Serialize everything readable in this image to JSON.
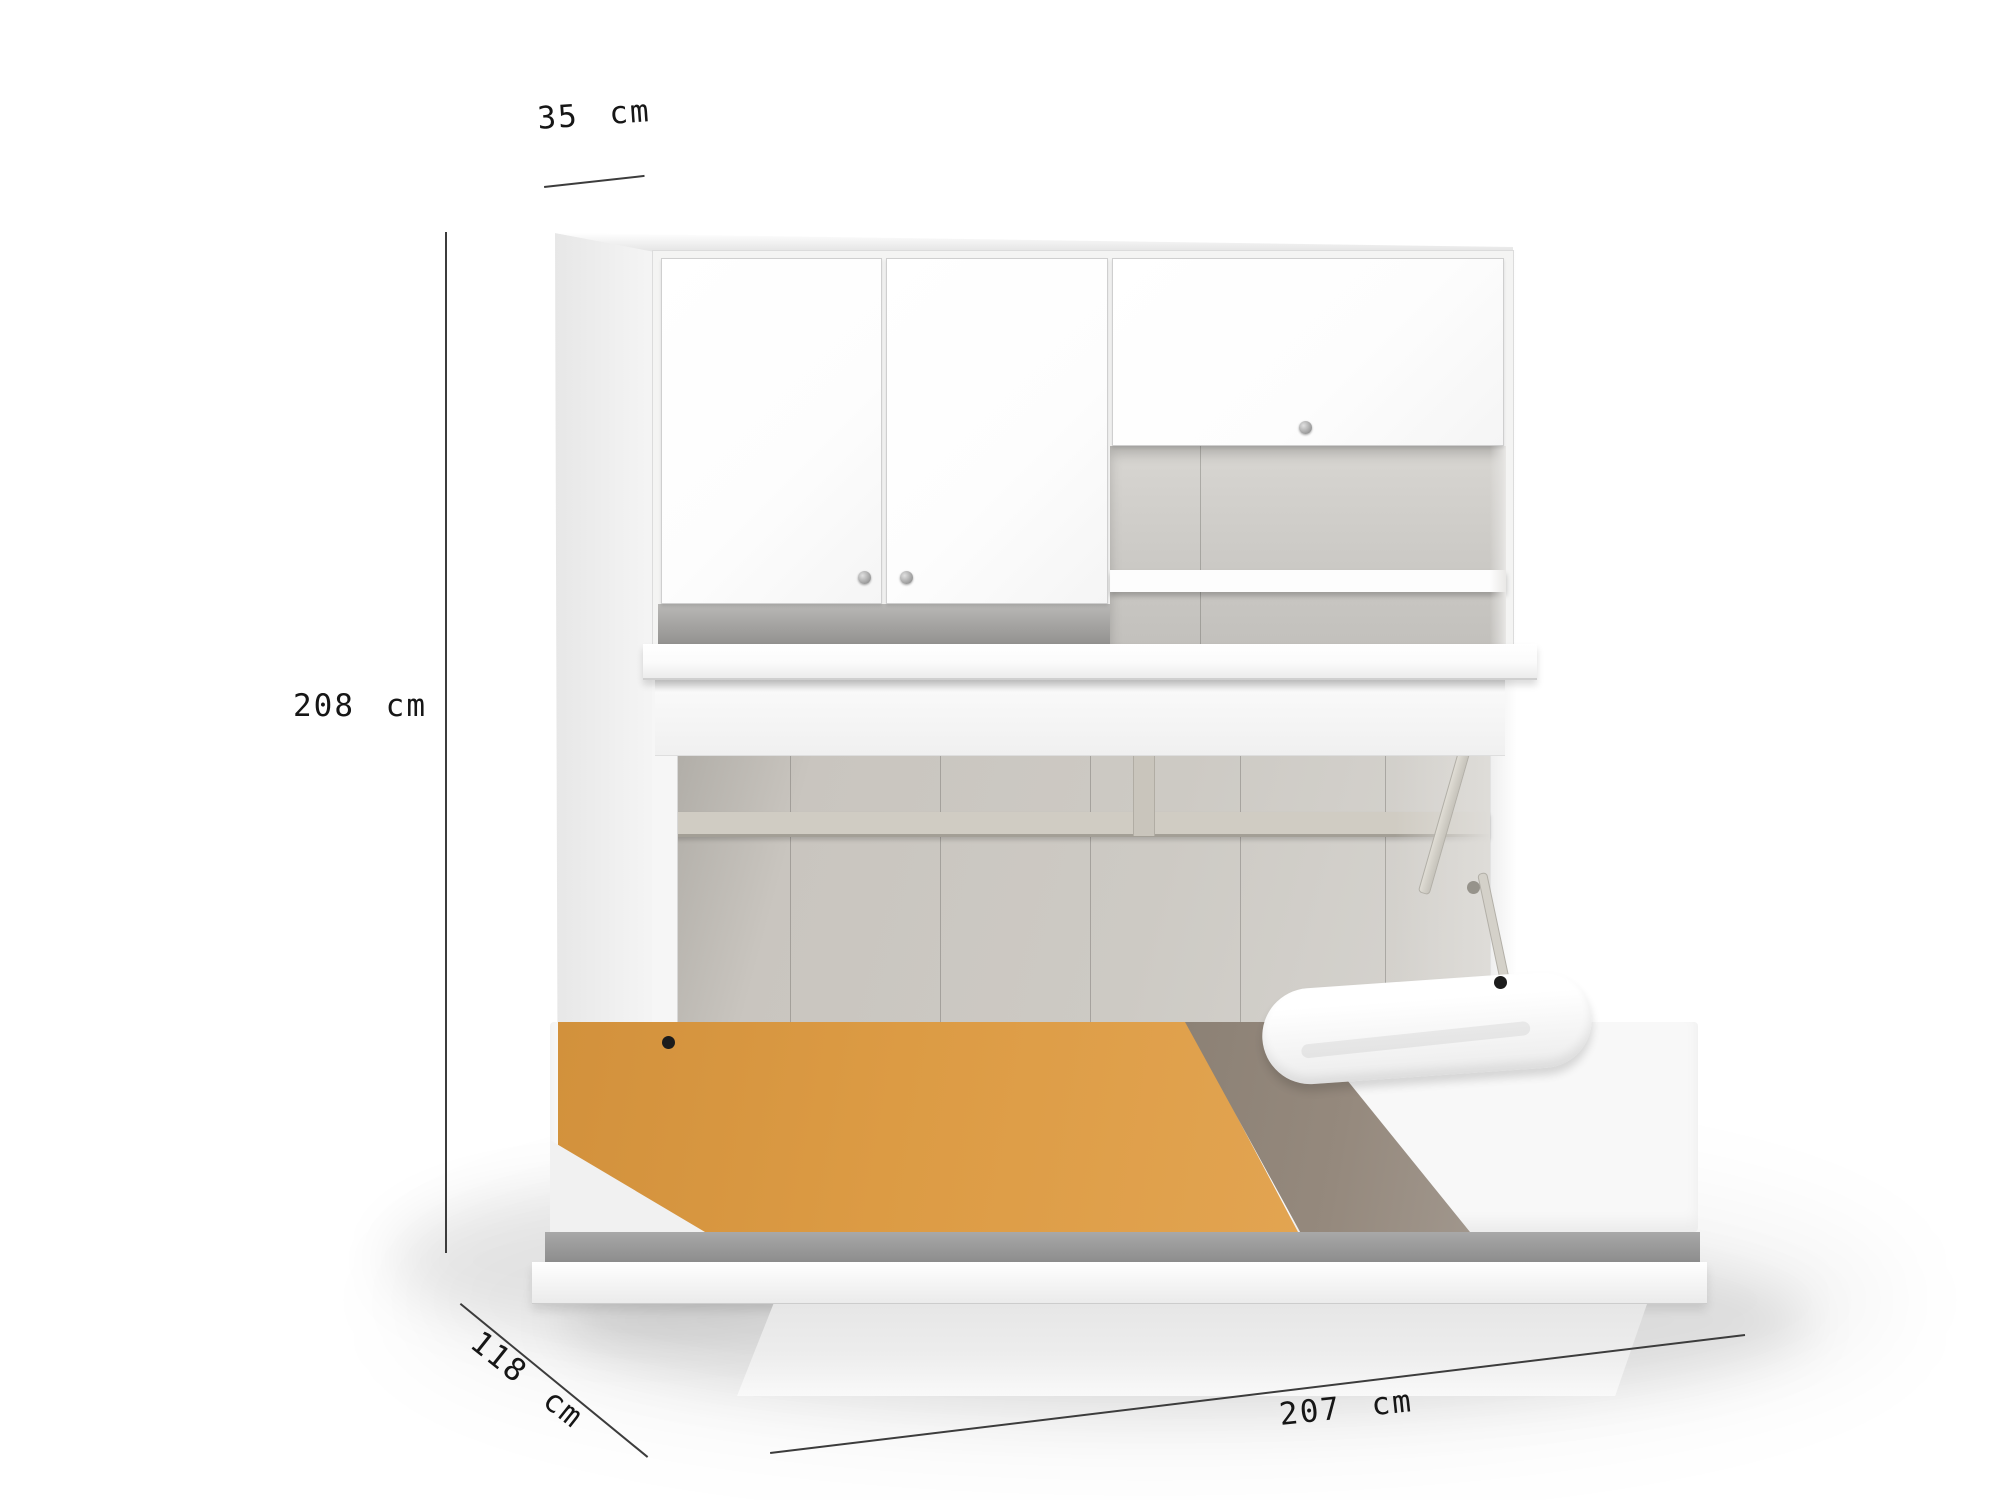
{
  "dimensions": {
    "depth_top": "35 cm",
    "height": "208 cm",
    "floor_depth": "118 cm",
    "width": "207 cm"
  },
  "palette": {
    "dim-line": "#3c3c3c",
    "dim-text": "#161616",
    "cabinet-face": "#f4f4f3",
    "door-white": "#fdfdfd",
    "door-border": "#cfcfcf",
    "interior-gray": "#c9c5bf",
    "interior-dark": "#97948e",
    "rail-beige": "#d0ccc3",
    "blanket-orange": "#dc9b44",
    "blanket-taupe": "#95897d",
    "mattress-white": "#f8f8f8",
    "platform-gray": "#9d9d9d",
    "pedestal-gray": "#ededed",
    "knob-gray": "#9b9b9b",
    "pin-black": "#1c1c1c"
  }
}
